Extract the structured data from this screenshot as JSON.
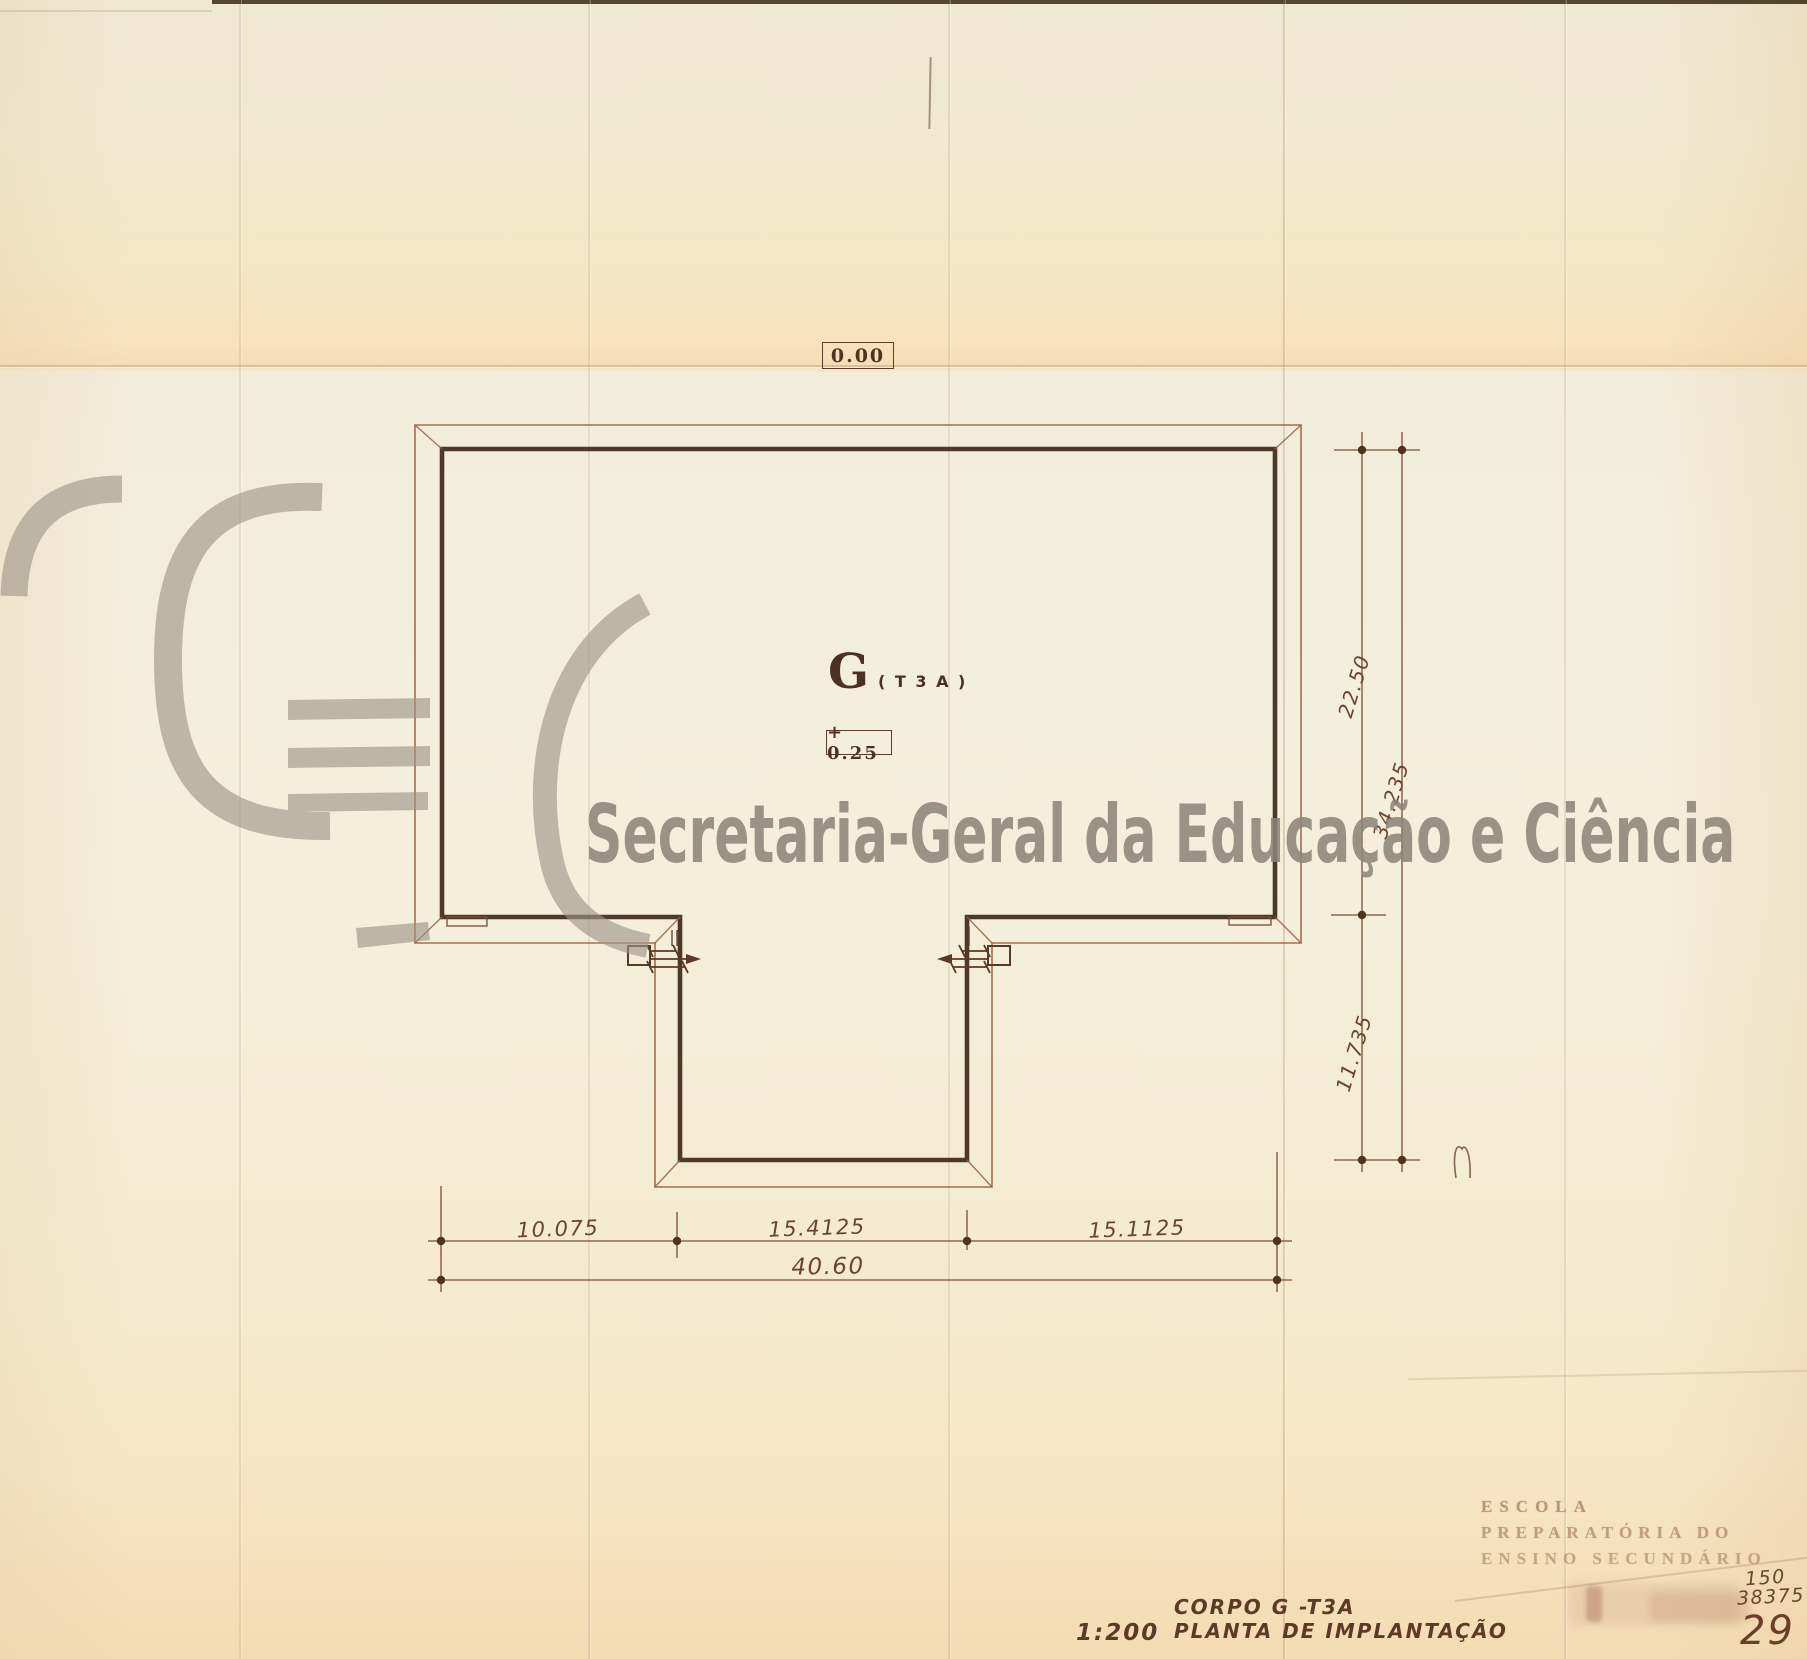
{
  "plan": {
    "datum": "0.00",
    "unit": "G",
    "unit_type": "( T 3 A )",
    "level": "+ 0.25"
  },
  "dims": {
    "right_segment_top": "22.50",
    "right_overall": "34.235",
    "right_segment_bottom": "11.735",
    "bottom_segment_1": "10.075",
    "bottom_segment_2": "15.4125",
    "bottom_segment_3": "15.1125",
    "bottom_overall": "40.60"
  },
  "watermark": {
    "text": "Secretaria-Geral da Educação e Ciência"
  },
  "stamp": {
    "line1": "ESCOLA",
    "line2": "PREPARATÓRIA DO",
    "line3": "ENSINO SECUNDÁRIO"
  },
  "titleblock": {
    "scale": "1:200",
    "body": "CORPO G -T3A",
    "title": "PLANTA DE IMPLANTAÇÃO"
  },
  "margin": {
    "ref_top": "150",
    "ref_bottom": "38375",
    "sheet_number": "29"
  },
  "colors": {
    "paper": "#f3ecd8",
    "wall_ink": "#3f2b1c",
    "eave_ink": "#9a5f43",
    "dimension_ink": "#7d4b34",
    "watermark_gray": "#8b8578"
  }
}
